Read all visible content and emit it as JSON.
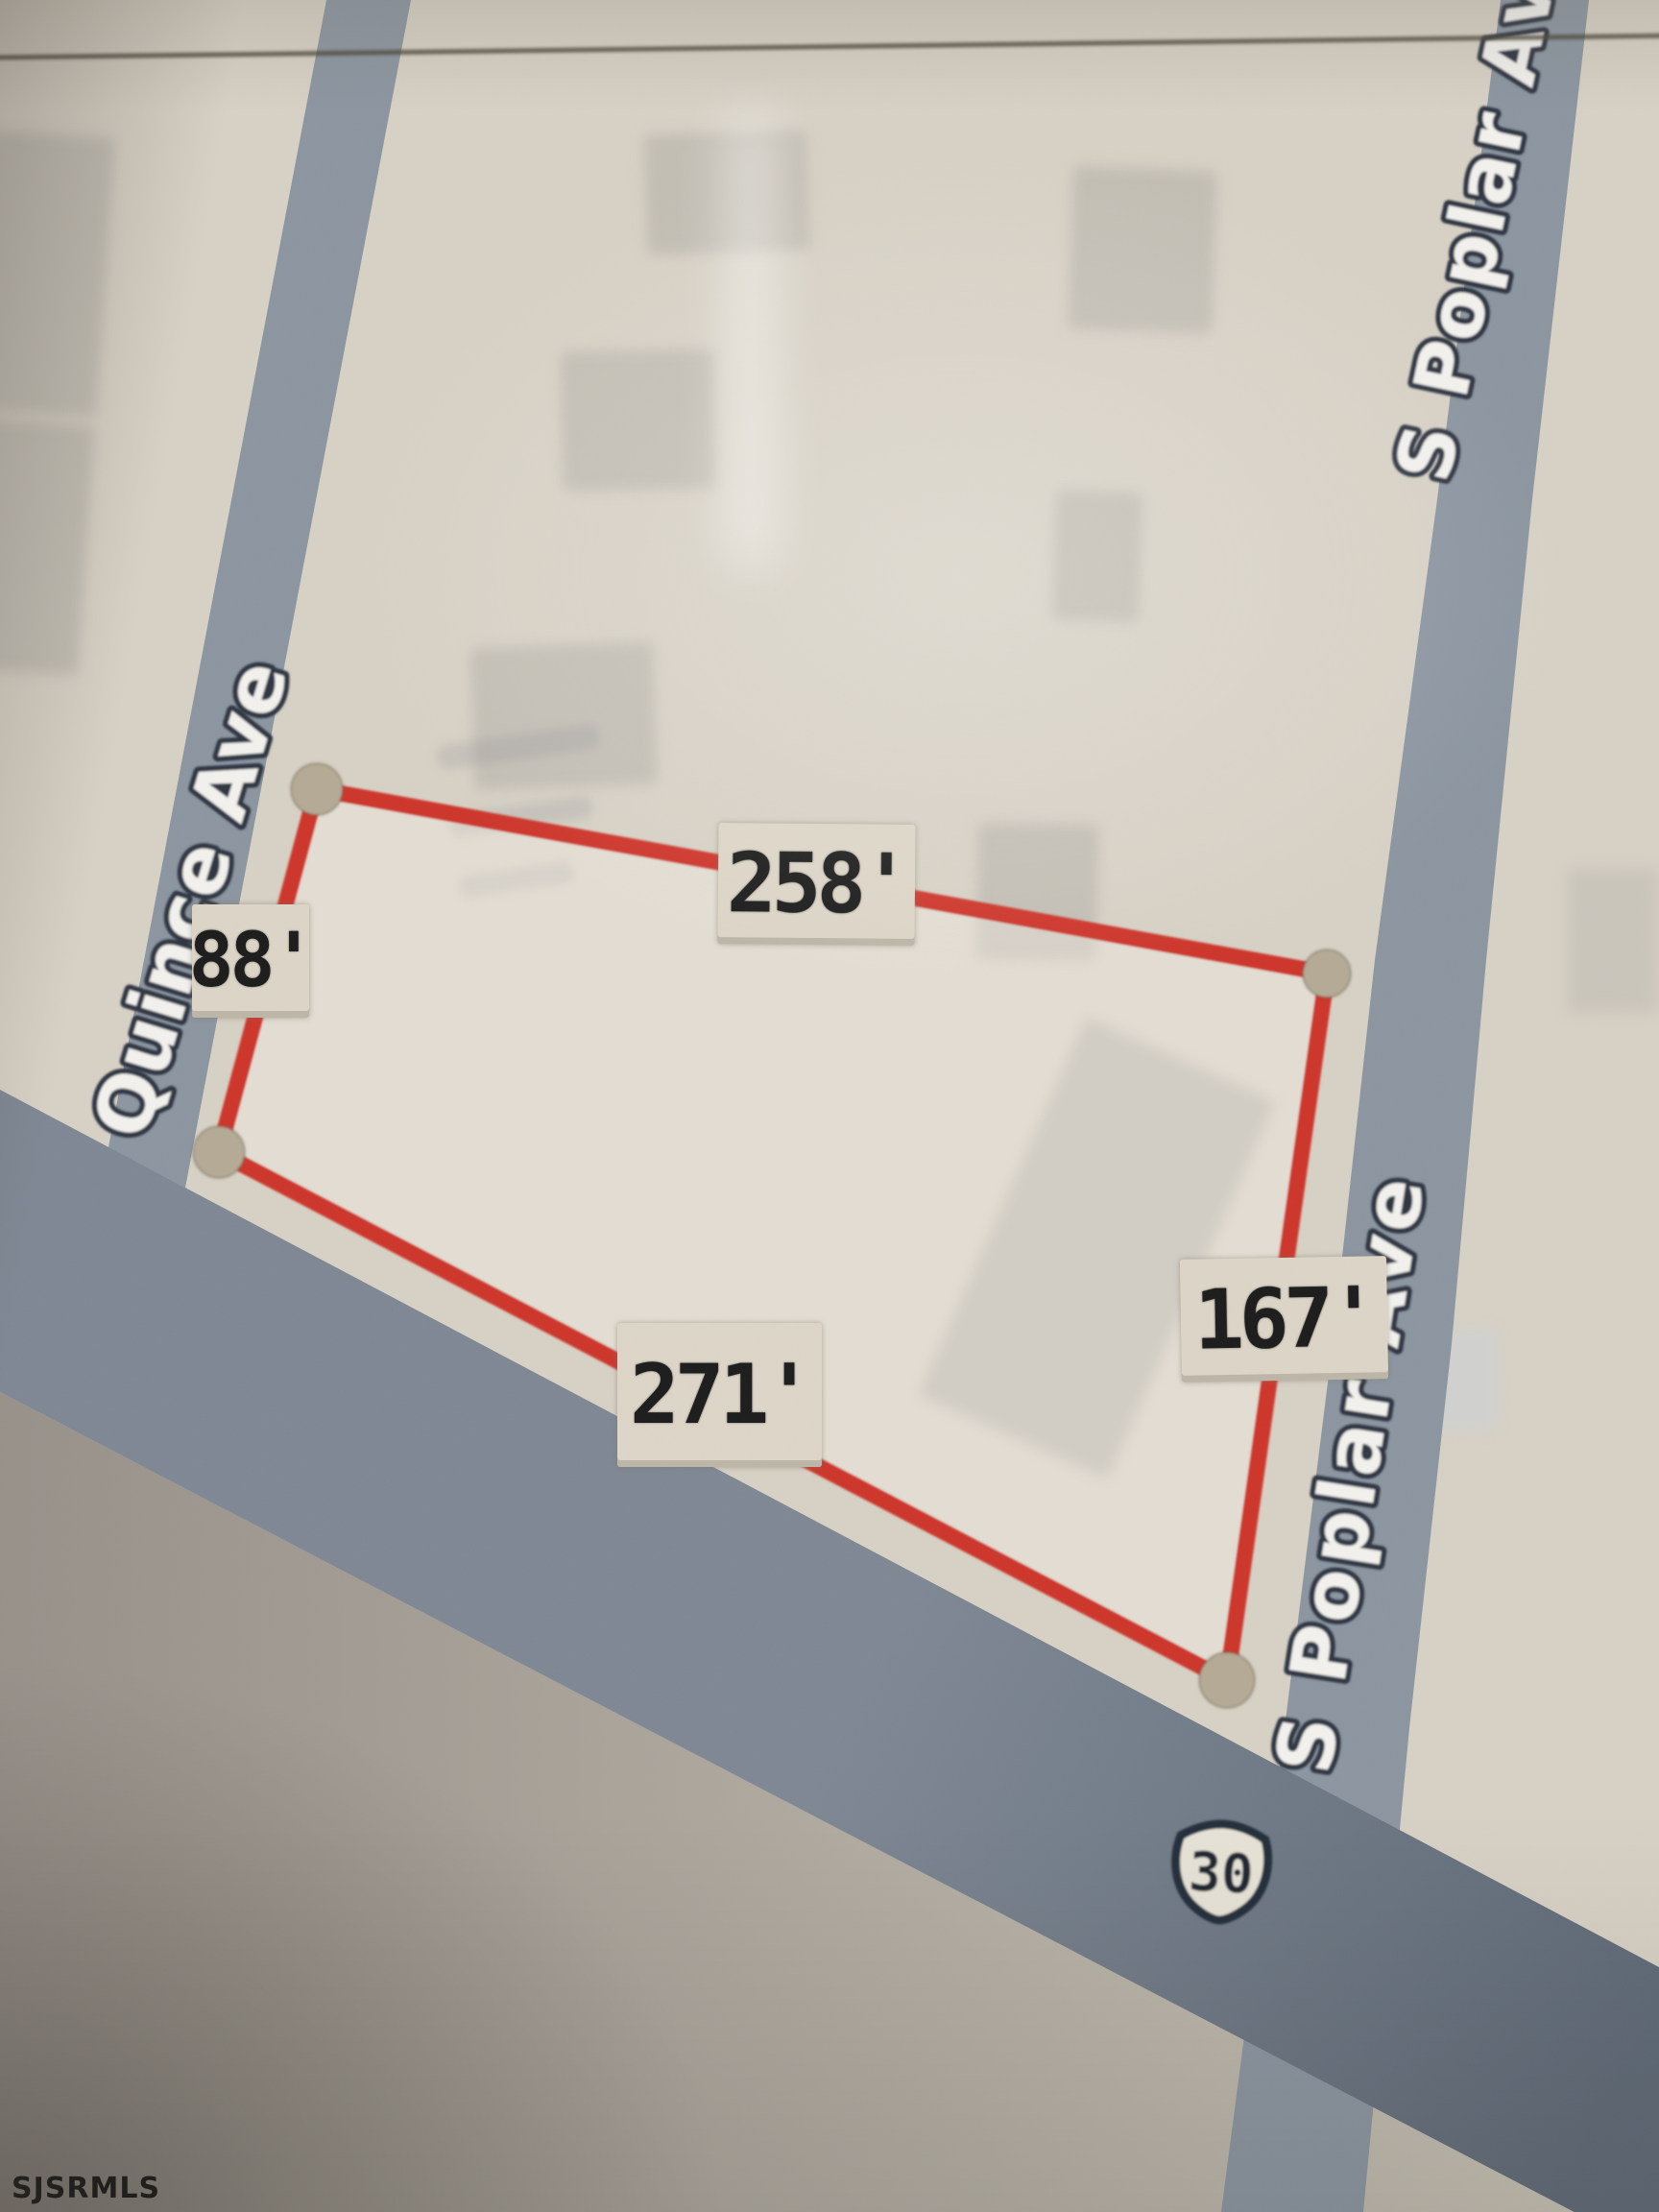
{
  "map": {
    "watermark": "SJSRMLS",
    "route_shield": {
      "number": "30"
    },
    "streets": {
      "quince": "Quince Ave",
      "poplar_upper": "S Poplar Av",
      "poplar_lower": "S Poplar Ave"
    },
    "parcel": {
      "side_lengths": {
        "left": "88'",
        "top": "258'",
        "right": "167'",
        "bottom": "271'"
      }
    },
    "colors": {
      "paper": "#d8d2c6",
      "road": "#8c96a1",
      "highway_dark": "#5f6a77",
      "highway_light": "#7e8894",
      "subroad_dark": "#97918a",
      "subroad_light": "#c7c1b4",
      "parcel_line": "#ce3529",
      "parcel_fill": "rgba(248,244,235,0.35)",
      "corner_dot": "#b5aa95",
      "label_bg": "#ddd6c8",
      "label_text": "#1b1b1b",
      "street_text": "#f3f2ee",
      "street_outline": "#2d3643",
      "shield_fill": "#e8e4d8",
      "shield_outline": "#242d3a"
    }
  }
}
